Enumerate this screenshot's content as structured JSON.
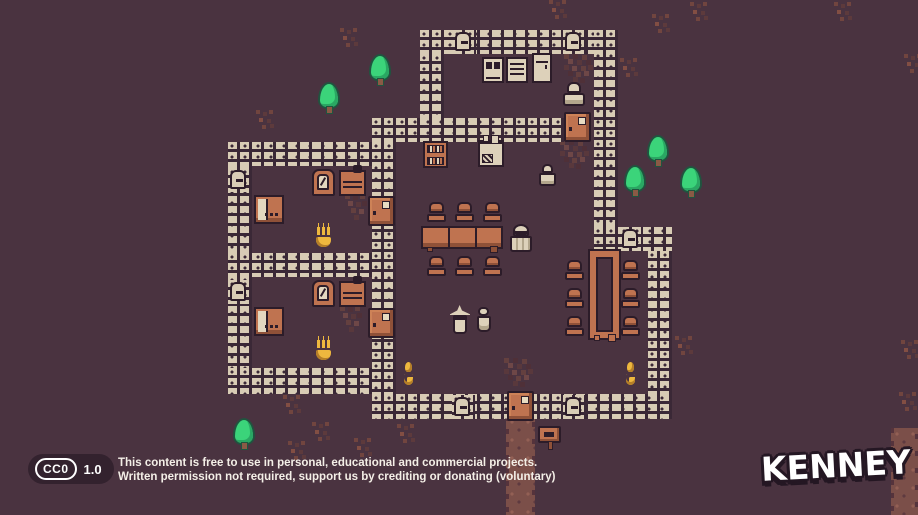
{
  "scene": {
    "width": 918,
    "height": 515,
    "colors": {
      "background": "#4a3340",
      "brick": "#d8ccb5",
      "mortar": "#3a2836",
      "outline": "#2c1c29",
      "wood_orange": "#bf7350",
      "wood_orange_dark": "#8f5138",
      "furniture_tan": "#ddd1ba",
      "flame_yellow": "#eeb83e",
      "tree_green": "#3bd47a",
      "path_brown": "#7b4f49",
      "dirt_red": "#64403f",
      "footer_badge_bg": "#33222e",
      "text_white": "#f4efe7"
    },
    "tiles": [
      {
        "t": "path",
        "x": 506,
        "y": 416,
        "w": 29,
        "h": 99
      },
      {
        "t": "path",
        "x": 891,
        "y": 428,
        "w": 27,
        "h": 87
      },
      {
        "t": "dirt",
        "x": 504,
        "y": 358
      },
      {
        "t": "dirt",
        "x": 560,
        "y": 140
      },
      {
        "t": "dirt",
        "x": 564,
        "y": 54
      },
      {
        "t": "rug",
        "x": 345,
        "y": 194
      },
      {
        "t": "rug",
        "x": 340,
        "y": 306
      },
      {
        "t": "decor",
        "x": 340,
        "y": 28
      },
      {
        "t": "decor",
        "x": 256,
        "y": 110
      },
      {
        "t": "decor",
        "x": 620,
        "y": 58
      },
      {
        "t": "decor",
        "x": 652,
        "y": 14
      },
      {
        "t": "decor",
        "x": 675,
        "y": 336
      },
      {
        "t": "decor",
        "x": 283,
        "y": 395
      },
      {
        "t": "decor",
        "x": 312,
        "y": 422
      },
      {
        "t": "decor",
        "x": 397,
        "y": 424
      },
      {
        "t": "decor",
        "x": 354,
        "y": 438
      },
      {
        "t": "decor",
        "x": 288,
        "y": 441
      },
      {
        "t": "decor",
        "x": 834,
        "y": 2
      },
      {
        "t": "decor",
        "x": 690,
        "y": 2
      },
      {
        "t": "decor",
        "x": 549,
        "y": 0
      },
      {
        "t": "decor",
        "x": 904,
        "y": 54
      },
      {
        "t": "decor",
        "x": 901,
        "y": 340
      },
      {
        "t": "decor",
        "x": 899,
        "y": 392
      },
      {
        "t": "wall",
        "x": 420,
        "y": 30,
        "w": 198,
        "h": 24
      },
      {
        "t": "wall",
        "x": 420,
        "y": 54,
        "w": 24,
        "h": 64
      },
      {
        "t": "wall",
        "x": 372,
        "y": 118,
        "w": 192,
        "h": 24
      },
      {
        "t": "wall",
        "x": 594,
        "y": 30,
        "w": 24,
        "h": 197
      },
      {
        "t": "wall",
        "x": 228,
        "y": 142,
        "w": 144,
        "h": 24
      },
      {
        "t": "wall",
        "x": 228,
        "y": 166,
        "w": 24,
        "h": 226
      },
      {
        "t": "wall",
        "x": 372,
        "y": 142,
        "w": 24,
        "h": 276
      },
      {
        "t": "wall",
        "x": 228,
        "y": 253,
        "w": 144,
        "h": 24
      },
      {
        "t": "wall",
        "x": 228,
        "y": 368,
        "w": 144,
        "h": 26
      },
      {
        "t": "wall",
        "x": 372,
        "y": 394,
        "w": 300,
        "h": 25
      },
      {
        "t": "wall",
        "x": 594,
        "y": 227,
        "w": 78,
        "h": 24
      },
      {
        "t": "wall",
        "x": 648,
        "y": 251,
        "w": 24,
        "h": 143
      },
      {
        "t": "window",
        "x": 453,
        "y": 30
      },
      {
        "t": "window",
        "x": 563,
        "y": 30
      },
      {
        "t": "window",
        "x": 228,
        "y": 168
      },
      {
        "t": "window",
        "x": 228,
        "y": 280
      },
      {
        "t": "window",
        "x": 620,
        "y": 227
      },
      {
        "t": "window",
        "x": 452,
        "y": 395
      },
      {
        "t": "window",
        "x": 563,
        "y": 395
      },
      {
        "t": "door",
        "x": 564,
        "y": 112
      },
      {
        "t": "door",
        "x": 368,
        "y": 196
      },
      {
        "t": "door",
        "x": 368,
        "y": 308
      },
      {
        "t": "door",
        "x": 507,
        "y": 391
      },
      {
        "t": "cabx",
        "x": 482,
        "y": 57
      },
      {
        "t": "cabd",
        "x": 506,
        "y": 57
      },
      {
        "t": "cabt",
        "x": 532,
        "y": 53
      },
      {
        "t": "bookshelf",
        "x": 423,
        "y": 141
      },
      {
        "t": "stove",
        "x": 478,
        "y": 140
      },
      {
        "t": "mirror",
        "x": 312,
        "y": 169
      },
      {
        "t": "dresser",
        "x": 339,
        "y": 170
      },
      {
        "t": "bed",
        "x": 254,
        "y": 195
      },
      {
        "t": "mirror",
        "x": 312,
        "y": 280
      },
      {
        "t": "dresser",
        "x": 339,
        "y": 281
      },
      {
        "t": "bed",
        "x": 254,
        "y": 307
      },
      {
        "t": "tableh",
        "x": 421,
        "y": 226
      },
      {
        "t": "chair",
        "x": 427,
        "y": 202
      },
      {
        "t": "chair",
        "x": 455,
        "y": 202
      },
      {
        "t": "chair",
        "x": 483,
        "y": 202
      },
      {
        "t": "chair",
        "x": 427,
        "y": 256
      },
      {
        "t": "chair",
        "x": 455,
        "y": 256
      },
      {
        "t": "chair",
        "x": 483,
        "y": 256
      },
      {
        "t": "tablev",
        "x": 590,
        "y": 251
      },
      {
        "t": "chair",
        "x": 565,
        "y": 260
      },
      {
        "t": "chair",
        "x": 565,
        "y": 288
      },
      {
        "t": "chair",
        "x": 565,
        "y": 316
      },
      {
        "t": "chair",
        "x": 621,
        "y": 260
      },
      {
        "t": "chair",
        "x": 621,
        "y": 288
      },
      {
        "t": "chair",
        "x": 621,
        "y": 316
      },
      {
        "t": "candle",
        "x": 314,
        "y": 222
      },
      {
        "t": "candle",
        "x": 314,
        "y": 335
      },
      {
        "t": "torch",
        "x": 402,
        "y": 362
      },
      {
        "t": "torch",
        "x": 624,
        "y": 362
      },
      {
        "t": "sign",
        "x": 538,
        "y": 426
      },
      {
        "t": "monk",
        "x": 562,
        "y": 82
      },
      {
        "t": "oldman",
        "x": 537,
        "y": 164
      },
      {
        "t": "cultist",
        "x": 509,
        "y": 224
      },
      {
        "t": "witch",
        "x": 450,
        "y": 305
      },
      {
        "t": "woman",
        "x": 475,
        "y": 307
      },
      {
        "t": "tree",
        "x": 320,
        "y": 84
      },
      {
        "t": "tree",
        "x": 371,
        "y": 56
      },
      {
        "t": "tree",
        "x": 649,
        "y": 137
      },
      {
        "t": "tree",
        "x": 626,
        "y": 167
      },
      {
        "t": "tree",
        "x": 682,
        "y": 168
      },
      {
        "t": "tree",
        "x": 235,
        "y": 420
      }
    ]
  },
  "footer": {
    "cc_label": "CC0",
    "version": "1.0",
    "line1": "This content is free to use in personal, educational and commercial projects.",
    "line2": "Written permission not required, support us by crediting or donating (voluntary)"
  },
  "brand": {
    "logo_text": "KENNEY"
  }
}
